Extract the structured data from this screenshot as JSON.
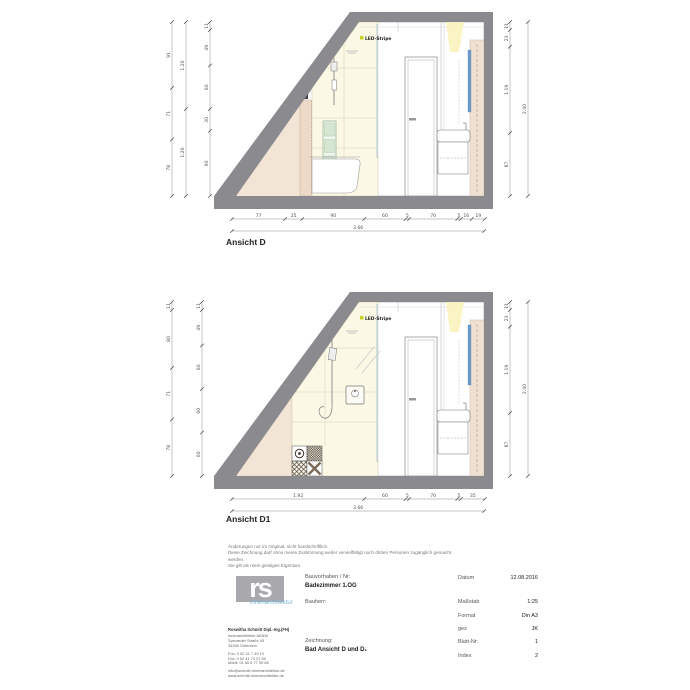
{
  "colors": {
    "wall_gray": "#8b8b8f",
    "pink_wall": "#f3e5d6",
    "pink_halfwall": "#ecd9c8",
    "cream_tile": "#fbf8e6",
    "tile_joint": "#d8d1b6",
    "green_niche": "#d5e7d1",
    "mirror_blue": "#6d9bcd",
    "light_glow": "#faf3bf",
    "led_dot": "#c3cf21",
    "dim_text": "#555555",
    "logo_gray": "#a9a9ad",
    "logo_cyan": "#7cb8da"
  },
  "drawings": [
    {
      "label": "Ansicht D",
      "led_label": "LED-Stripe",
      "dims": {
        "bottom": [
          "77",
          "25",
          "90",
          "60",
          "5",
          "70",
          "5",
          "16",
          "19"
        ],
        "bottom_total": [
          "3.66"
        ],
        "left_outer": [
          "91",
          "71",
          "78"
        ],
        "left_mid": [
          "1.20",
          "1.20"
        ],
        "left_inner": [
          "11",
          "49",
          "60",
          "30",
          "90"
        ],
        "right_inner": [
          "11",
          "23",
          "1.19",
          "87"
        ],
        "right_total": [
          "2.40"
        ]
      }
    },
    {
      "label": "Ansicht D1",
      "led_label": "LED-Stripe",
      "dims": {
        "bottom": [
          "1.92",
          "60",
          "5",
          "70",
          "5",
          "35"
        ],
        "bottom_total": [
          "3.66"
        ],
        "left_outer": [
          "11",
          "80",
          "71",
          "78"
        ],
        "left_inner": [
          "11",
          "49",
          "60",
          "60",
          "60"
        ],
        "right_inner": [
          "11",
          "23",
          "1.19",
          "87"
        ],
        "right_total": [
          "2.40"
        ]
      }
    }
  ],
  "notes": {
    "lines": [
      "Änderungen nur im Original, nicht handschriftlich.",
      "Diese Zeichnung darf ohne meine Zustimmung weder vervielfältigt noch dritten Personen zugänglich gemacht",
      "werden.",
      "Sie gilt als mein geistiges Eigentum."
    ]
  },
  "title_block": {
    "logo_text": "rs",
    "logo_sub": "innenarchitektur",
    "architect": {
      "name": "Roswitha Schmitt Dipl.-Ing.(FH)",
      "address": [
        "Innenarchitektin AKNW",
        "Spexarder Straße 45",
        "33335 Gütersloh"
      ],
      "contact": [
        "Fon:  0 52 41 7 49 10",
        "Fax:  0 52 41 74 07 50",
        "Mobil: 01 60 6 77 09 68"
      ],
      "web": [
        "info@schmitt-innenarchitektur.de",
        "www.schmitt-innenarchitektur.de"
      ]
    },
    "fields": {
      "bauvorhaben_label": "Bauvorhaben / Nr:",
      "bauvorhaben_value": "Badezimmer 1.OG",
      "bauherr_label": "Bauherr:",
      "zeichnung_label": "Zeichnung:",
      "zeichnung_value": "Bad Ansicht D und D₁"
    },
    "meta": [
      {
        "label": "Datum",
        "value": "12.08.2016"
      },
      {
        "label": "Maßstab",
        "value": "1:25"
      },
      {
        "label": "Format",
        "value": "Din A3"
      },
      {
        "label": "gez",
        "value": "JK"
      },
      {
        "label": "Blatt-Nr:",
        "value": "1"
      },
      {
        "label": "Index",
        "value": "2"
      }
    ]
  }
}
